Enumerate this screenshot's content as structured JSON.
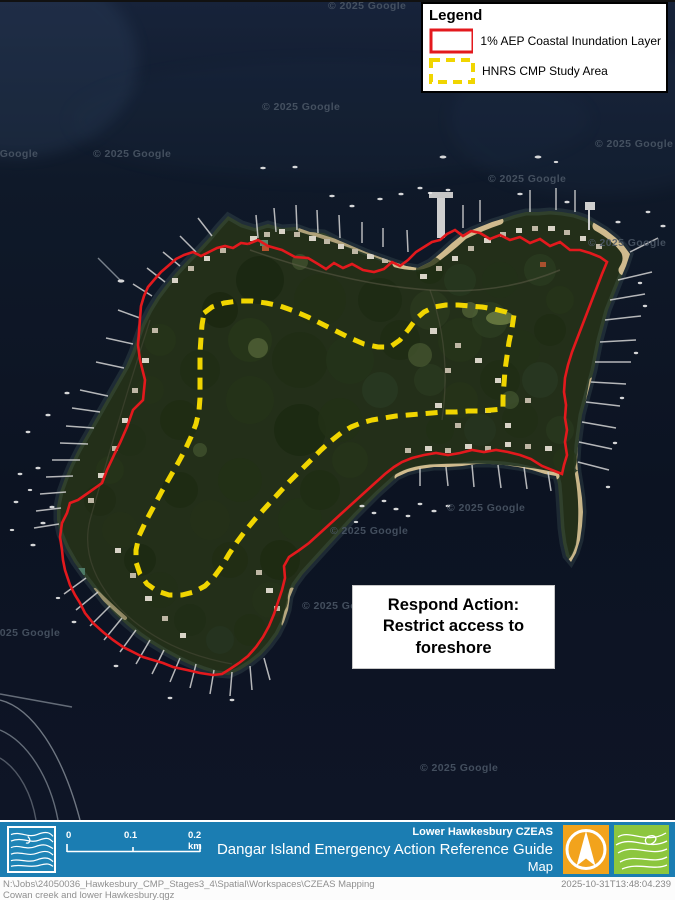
{
  "map": {
    "watermark": "© 2025 Google",
    "annotation": {
      "line1": "Respond Action:",
      "line2": "Restrict access to",
      "line3": "foreshore"
    }
  },
  "legend": {
    "title": "Legend",
    "items": [
      {
        "label": "1% AEP Coastal Inundation Layer",
        "swatch": "red-solid-outline"
      },
      {
        "label": "HNRS CMP Study Area",
        "swatch": "yellow-dashed-outline"
      }
    ]
  },
  "footer": {
    "region_label": "Lower Hawkesbury CZEAS",
    "title": "Dangar Island Emergency Action Reference Guide",
    "subtitle": "Map",
    "scale_bar": {
      "t0": "0",
      "t1": "0.1",
      "t2": "0.2 km"
    },
    "logos": [
      "contour-lines-blue",
      "north-arrow-orange",
      "contour-lines-green"
    ]
  },
  "credits": {
    "path": "N:\\Jobs\\24050036_Hawkesbury_CMP_Stages3_4\\Spatial\\Workspaces\\CZEAS  Mapping",
    "project": "Cowan creek and lower Hawkesbury.qgz",
    "timestamp": "2025-10-31T13:48:04.239"
  },
  "colors": {
    "inundation_layer": "#e3191d",
    "study_area": "#f0d500",
    "footer_blue": "#1b7db2",
    "logo_orange": "#f2a31c",
    "logo_green": "#8cc63e"
  }
}
